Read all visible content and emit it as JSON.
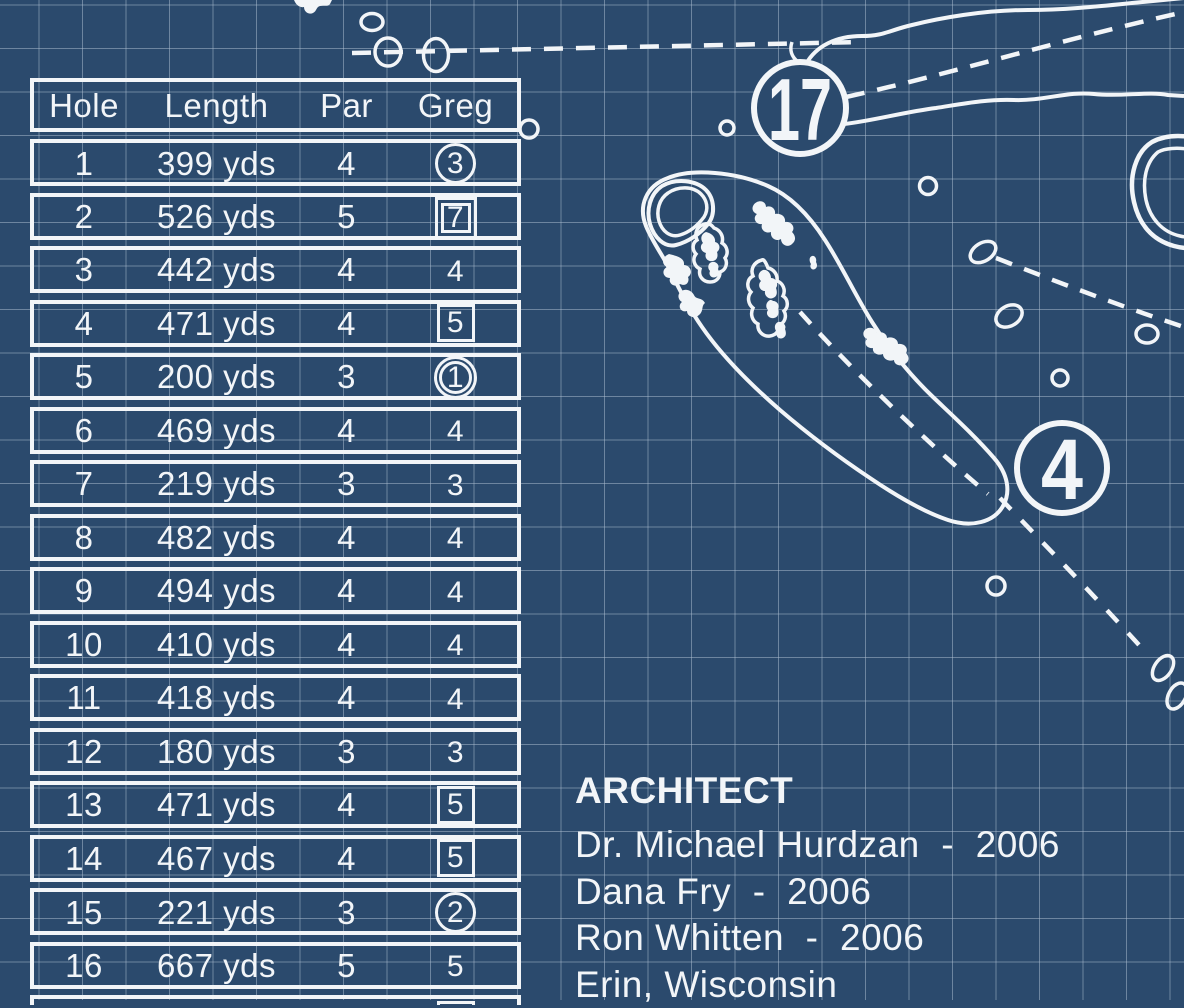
{
  "colors": {
    "background": "#2b4a6d",
    "ink": "#f2f5f8",
    "grid_line": "#b0c0d3"
  },
  "scorecard": {
    "headers": [
      "Hole",
      "Length",
      "Par",
      "Greg"
    ],
    "rows": [
      {
        "hole": "1",
        "length": "399 yds",
        "par": "4",
        "score": "3",
        "marker": "circle"
      },
      {
        "hole": "2",
        "length": "526 yds",
        "par": "5",
        "score": "7",
        "marker": "double-square"
      },
      {
        "hole": "3",
        "length": "442 yds",
        "par": "4",
        "score": "4",
        "marker": "none"
      },
      {
        "hole": "4",
        "length": "471 yds",
        "par": "4",
        "score": "5",
        "marker": "square"
      },
      {
        "hole": "5",
        "length": "200 yds",
        "par": "3",
        "score": "1",
        "marker": "double-circle"
      },
      {
        "hole": "6",
        "length": "469 yds",
        "par": "4",
        "score": "4",
        "marker": "none"
      },
      {
        "hole": "7",
        "length": "219 yds",
        "par": "3",
        "score": "3",
        "marker": "none"
      },
      {
        "hole": "8",
        "length": "482 yds",
        "par": "4",
        "score": "4",
        "marker": "none"
      },
      {
        "hole": "9",
        "length": "494 yds",
        "par": "4",
        "score": "4",
        "marker": "none"
      },
      {
        "hole": "10",
        "length": "410 yds",
        "par": "4",
        "score": "4",
        "marker": "none"
      },
      {
        "hole": "11",
        "length": "418 yds",
        "par": "4",
        "score": "4",
        "marker": "none"
      },
      {
        "hole": "12",
        "length": "180 yds",
        "par": "3",
        "score": "3",
        "marker": "none"
      },
      {
        "hole": "13",
        "length": "471 yds",
        "par": "4",
        "score": "5",
        "marker": "square"
      },
      {
        "hole": "14",
        "length": "467 yds",
        "par": "4",
        "score": "5",
        "marker": "square"
      },
      {
        "hole": "15",
        "length": "221 yds",
        "par": "3",
        "score": "2",
        "marker": "circle"
      },
      {
        "hole": "16",
        "length": "667 yds",
        "par": "5",
        "score": "5",
        "marker": "none"
      }
    ],
    "partial_row": {
      "marker": "square"
    }
  },
  "architect": {
    "heading": "ARCHITECT",
    "lines": [
      "Dr. Michael Hurdzan  -  2006",
      "Dana Fry  -  2006",
      "Ron Whitten  -  2006",
      "Erin, Wisconsin"
    ]
  },
  "map": {
    "hole_markers": [
      {
        "label": "17"
      },
      {
        "label": "4"
      }
    ]
  }
}
